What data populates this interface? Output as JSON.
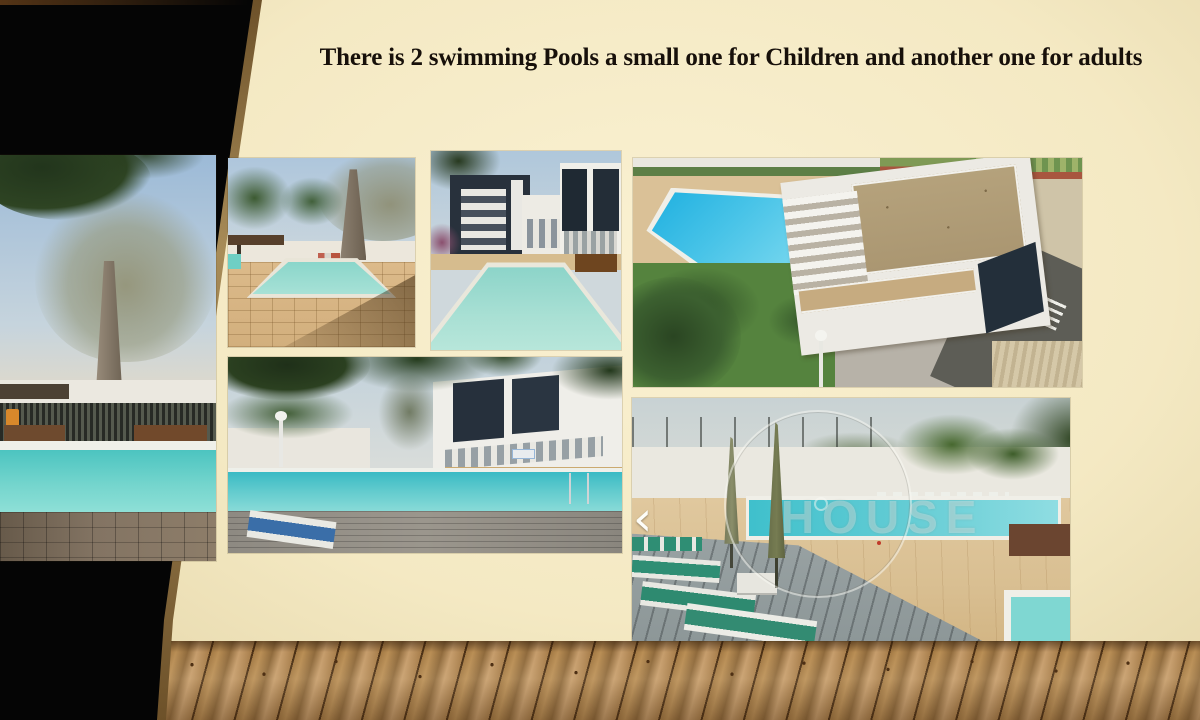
{
  "slide": {
    "title": "There is 2 swimming Pools a small one for Children and another one for adults"
  },
  "gallery": {
    "watermark_text": "HOUSE",
    "carousel_prev_glyph": "‹"
  },
  "colors": {
    "background_cream": "#f4e9c3",
    "wedge_black": "#050505",
    "edge_tan": "#a88c58",
    "wood_brown": "#a87e4b",
    "pool_teal": "#5fcfc8",
    "pool_azure": "#27b5e2",
    "title_text": "#17100a"
  }
}
